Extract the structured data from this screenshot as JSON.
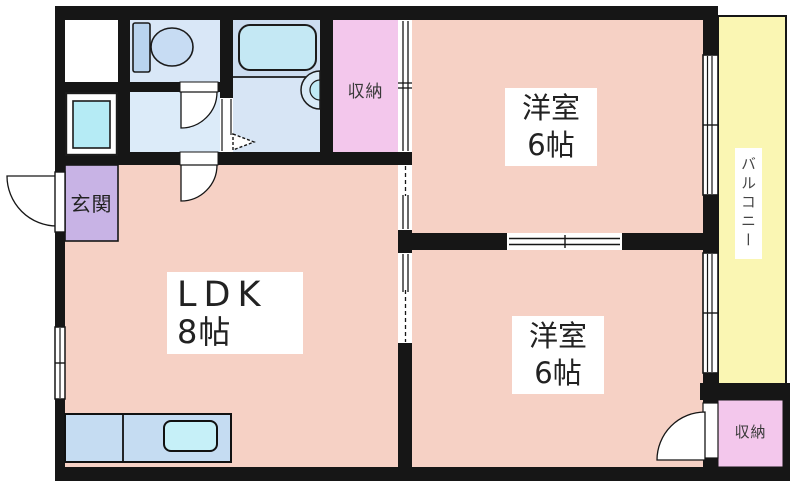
{
  "floorplan": {
    "title": "2DK apartment floor plan",
    "entrance": {
      "label": "玄関"
    },
    "ldk": {
      "name": "LDK",
      "size": "8帖"
    },
    "bedroom_top": {
      "name": "洋室",
      "size": "6帖"
    },
    "bedroom_bottom": {
      "name": "洋室",
      "size": "6帖"
    },
    "storage_top": {
      "label": "収納"
    },
    "storage_bottom": {
      "label": "収納"
    },
    "balcony": {
      "label": "バルコニー"
    },
    "colors": {
      "room_pink": "#f6d1c5",
      "storage_pink": "#f3c7ec",
      "entrance_purple": "#c8b3e5",
      "balcony_yellow": "#faf6b3",
      "toilet_blue": "#d9e7f7",
      "washroom_blue": "#dcebf9",
      "bathroom_blue": "#ccddf0",
      "fixture_cyan": "#bfeaf5",
      "kitchen_blue": "#c5dcf2",
      "wall_black": "#161616"
    }
  }
}
